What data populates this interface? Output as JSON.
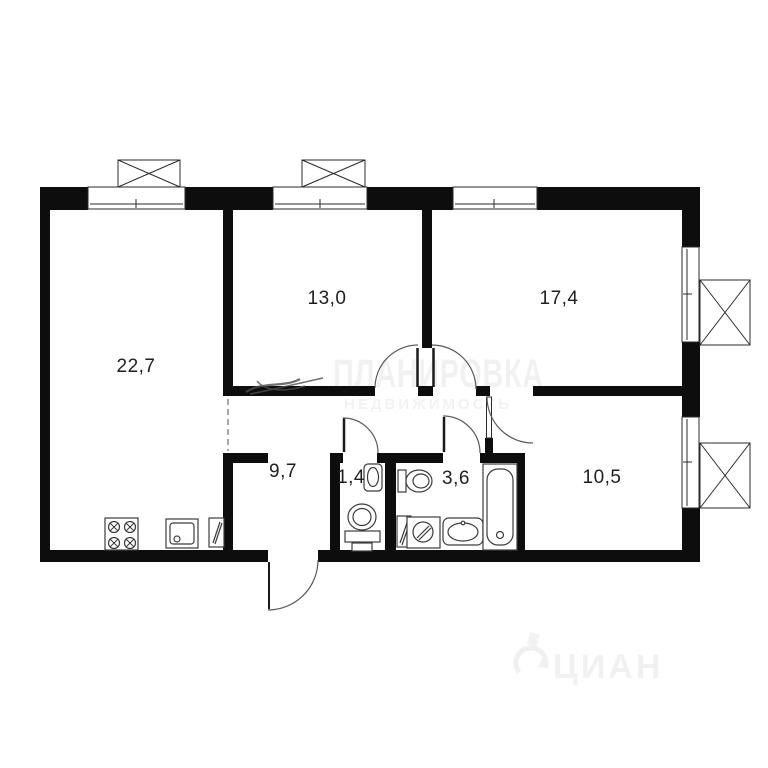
{
  "plan": {
    "type": "apartment-floor-plan",
    "rooms": [
      {
        "name": "living-kitchen",
        "area": "22,7"
      },
      {
        "name": "bedroom-1",
        "area": "13,0"
      },
      {
        "name": "bedroom-2",
        "area": "17,4"
      },
      {
        "name": "hallway",
        "area": "9,7"
      },
      {
        "name": "wc",
        "area": "1,4"
      },
      {
        "name": "bathroom",
        "area": "3,6"
      },
      {
        "name": "bedroom-3",
        "area": "10,5"
      }
    ],
    "fixtures": [
      "stove",
      "kitchen-sink",
      "water-heater",
      "wc-toilet",
      "wc-basin",
      "bathroom-toilet",
      "bathroom-cabinet",
      "washing-machine",
      "bathroom-sink",
      "bathtub"
    ],
    "openings": {
      "windows": 5,
      "vent_boxes": 4,
      "door_arcs": 6,
      "entrance_door": 1,
      "dashed_opening": 1
    },
    "colors": {
      "wall": "#0d0d0d",
      "fixture_line": "#3c3c3c",
      "arc_line": "#595959",
      "watermark_light": "#f1f1f1",
      "background": "#ffffff"
    }
  },
  "watermarks": {
    "center_text": "ПЛАНИРОВКА",
    "center_subtext": "НЕДВИЖИМОСТЬ",
    "corner_text": "ЦИАН"
  }
}
